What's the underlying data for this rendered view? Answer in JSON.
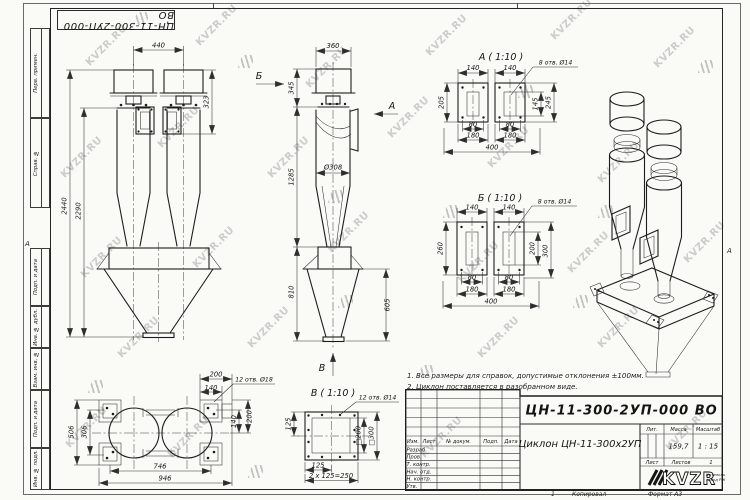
{
  "sheet": {
    "format": "А3"
  },
  "frame": {
    "zone_letter": "А",
    "top_stamp": "ЦН-11-300-2УП-000 ВО",
    "left_labels": [
      "Перв. примен.",
      "Справ. №",
      "Подп. и дата",
      "Инв. № дубл.",
      "Взам. инв. №",
      "Подп. и дата",
      "Инв. № подл."
    ]
  },
  "watermark": {
    "text": "KVZR.RU"
  },
  "notes": {
    "line1": "1. Все размеры для справок, допустимые отклонения ±100мм.",
    "line2": "2. Циклон поставляется в разобранном виде."
  },
  "views": {
    "front": {
      "dims": {
        "d440": "440",
        "d323": "323",
        "d2440": "2440",
        "d2290": "2290"
      }
    },
    "side": {
      "labels": {
        "a": "А",
        "b": "Б",
        "v": "В"
      },
      "dims": {
        "d360": "360",
        "d345": "345",
        "d1285": "1285",
        "d308": "Ø308",
        "d810": "810",
        "d605": "605"
      }
    },
    "detail_a": {
      "title": "А ( 1:10 )",
      "callout": "8 отв. Ø14",
      "dims": {
        "d140": "140",
        "d205": "205",
        "d145": "145",
        "d245": "245",
        "d80": "80",
        "d180": "180",
        "d400": "400"
      }
    },
    "detail_b": {
      "title": "Б ( 1:10 )",
      "callout": "8 отв. Ø14",
      "dims": {
        "d140": "140",
        "d260": "260",
        "d200": "200",
        "d300": "300",
        "d80": "80",
        "d180": "180",
        "d400": "400"
      }
    },
    "detail_v": {
      "title": "В ( 1:10 )",
      "callout": "12 отв. Ø14",
      "dims": {
        "d125": "125",
        "d250": "2 х 125=250",
        "s200": "□200",
        "s300": "□300"
      }
    },
    "plan": {
      "callout": "12 отв. Ø18",
      "dims": {
        "d200": "200",
        "d140": "140",
        "d506": "506",
        "d306": "306",
        "d746": "746",
        "d946": "946"
      }
    }
  },
  "title_block": {
    "doc_number": "ЦН-11-300-2УП-000 ВО",
    "product_name": "Циклон ЦН-11-300х2УП",
    "header_cols": [
      "Изм.",
      "Лист",
      "№ докум.",
      "Подп.",
      "Дата"
    ],
    "role_rows": [
      "Разраб.",
      "Пров.",
      "Т. контр.",
      "Нач. отд.",
      "Н. контр.",
      "Утв."
    ],
    "lit_label": "Лит.",
    "mass_label": "Масса",
    "scale_label": "Масштаб",
    "mass_value": "159,7",
    "scale_value": "1 : 15",
    "sheet_label": "Лист",
    "sheets_label": "Листов",
    "sheets_value": "1",
    "company_name": "KVZR",
    "company_sub1": "Котельный",
    "company_sub2": "завод РЭП",
    "copy_label": "Копировал",
    "format_label": "Формат А3",
    "page_num": "1"
  }
}
